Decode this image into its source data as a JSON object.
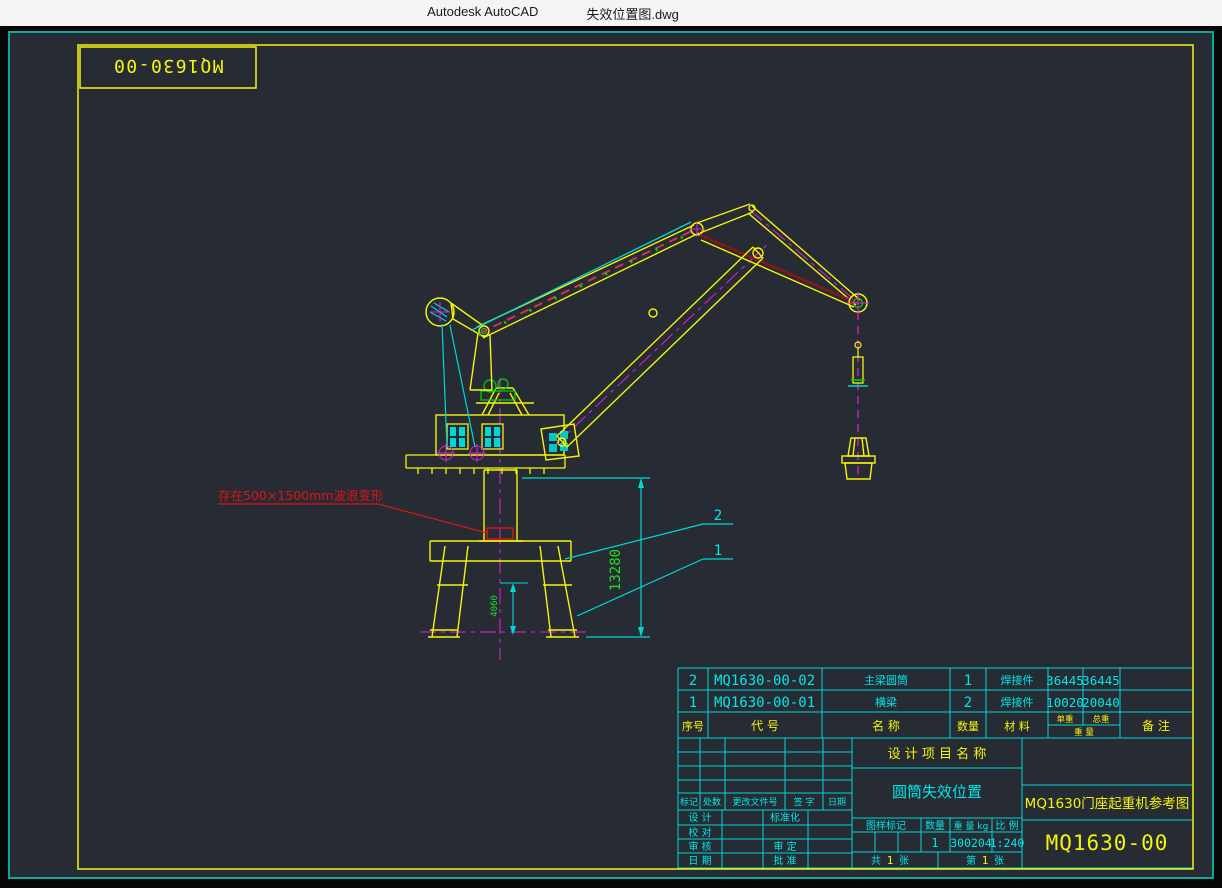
{
  "window": {
    "app_title": "Autodesk AutoCAD",
    "doc_title": "失效位置图.dwg"
  },
  "sheet": {
    "corner_label": "MQ1630-00"
  },
  "annotation": {
    "failure_note": "存在500×1500mm波浪变形"
  },
  "dimensions": {
    "total_height": "13280",
    "base_height": "4060"
  },
  "callouts": {
    "item2": "2",
    "item1": "1"
  },
  "bom": {
    "headers": {
      "seq": "序号",
      "code": "代  号",
      "name": "名  称",
      "qty": "数量",
      "material": "材  料",
      "unit_weight": "单重",
      "total_weight": "总重",
      "weight": "重 量",
      "remark": "备  注"
    },
    "rows": [
      {
        "seq": "2",
        "code": "MQ1630-00-02",
        "name": "主梁圆筒",
        "qty": "1",
        "material": "焊接件",
        "unit_weight": "36445",
        "total_weight": "36445"
      },
      {
        "seq": "1",
        "code": "MQ1630-00-01",
        "name": "横梁",
        "qty": "2",
        "material": "焊接件",
        "unit_weight": "10020",
        "total_weight": "20040"
      }
    ]
  },
  "title_block": {
    "project_label": "设 计 项 目 名 称",
    "drawing_title": "圆筒失效位置",
    "reference_title": "MQ1630门座起重机参考图",
    "drawing_number": "MQ1630-00",
    "revision": {
      "mark": "标记",
      "count": "处数",
      "change_doc": "更改文件号",
      "sign": "签 字",
      "date": "日期"
    },
    "roles": {
      "design": "设 计",
      "check": "校 对",
      "review": "审 核",
      "date": "日 期",
      "standard": "标准化",
      "approve_check": "审 定",
      "approve": "批 准"
    },
    "spec": {
      "mark_label": "图样标记",
      "qty_label": "数量",
      "weight_label": "重 量 kg",
      "scale_label": "比 例",
      "qty": "1",
      "weight": "300204",
      "scale": "1:240"
    },
    "sheets": {
      "total_prefix": "共",
      "total_num": "1",
      "total_suffix": "张",
      "page_prefix": "第",
      "page_num": "1",
      "page_suffix": "张"
    }
  },
  "colors": {
    "canvas_bg": "#262b34",
    "frame_yellow": "#f5f50a",
    "table_cyan": "#00d9d9",
    "dim_green": "#22dd22",
    "centerline_magenta": "#dd22dd",
    "alert_red": "#e01414",
    "tie_darkred": "#8b1616",
    "window_border_teal": "#0ca89b"
  }
}
